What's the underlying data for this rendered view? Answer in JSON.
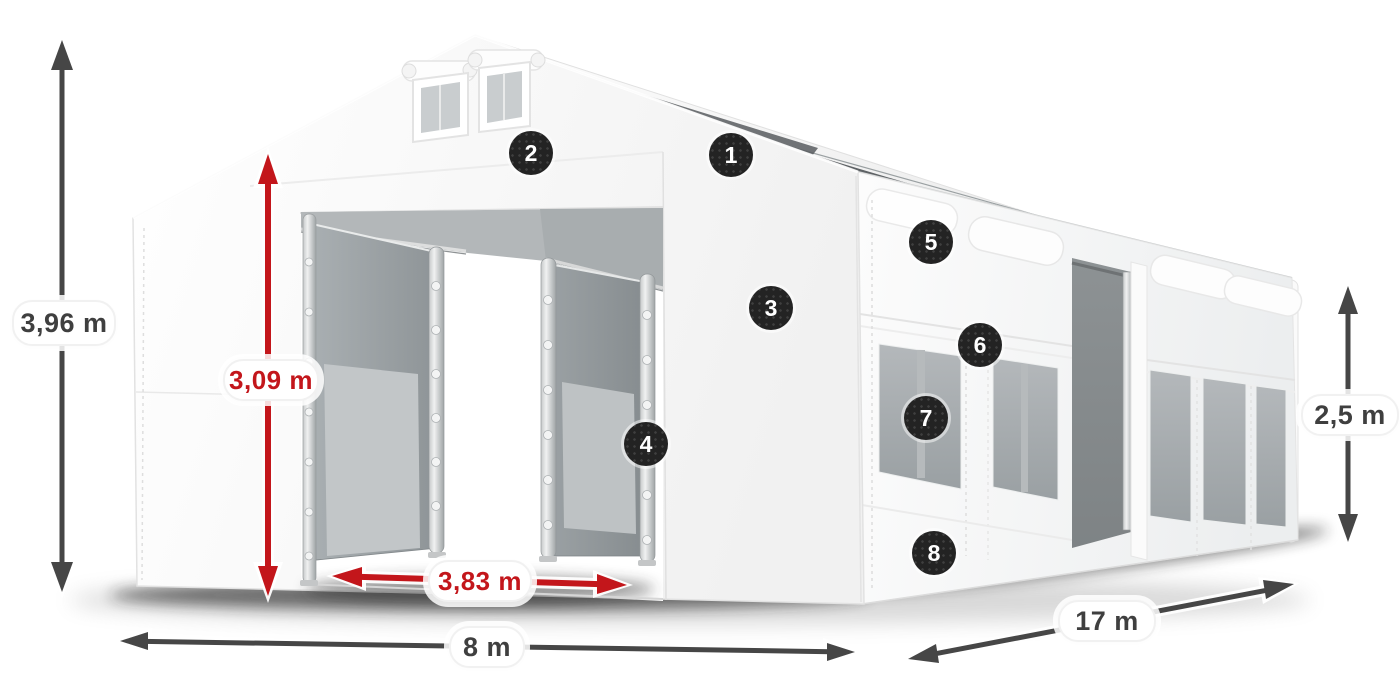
{
  "diagram": {
    "dimensions": {
      "total_height": "3,96 m",
      "entrance_height": "3,09 m",
      "entrance_width": "3,83 m",
      "width": "8 m",
      "length": "17 m",
      "side_height": "2,5 m"
    },
    "callouts": [
      {
        "number": "1"
      },
      {
        "number": "2"
      },
      {
        "number": "3"
      },
      {
        "number": "4"
      },
      {
        "number": "5"
      },
      {
        "number": "6"
      },
      {
        "number": "7"
      },
      {
        "number": "8"
      }
    ],
    "colors": {
      "background": "#ffffff",
      "dimension_arrow_dark": "#464646",
      "dimension_arrow_red": "#c3161b",
      "label_text_dark": "#3f3f3f",
      "label_text_red": "#c3161b",
      "badge_background": "#232323",
      "badge_text": "#ffffff",
      "tent_fabric": "#ffffff",
      "tent_interior_gray": "#b3b7b9",
      "window_mesh_gray": "#a6abae"
    }
  }
}
